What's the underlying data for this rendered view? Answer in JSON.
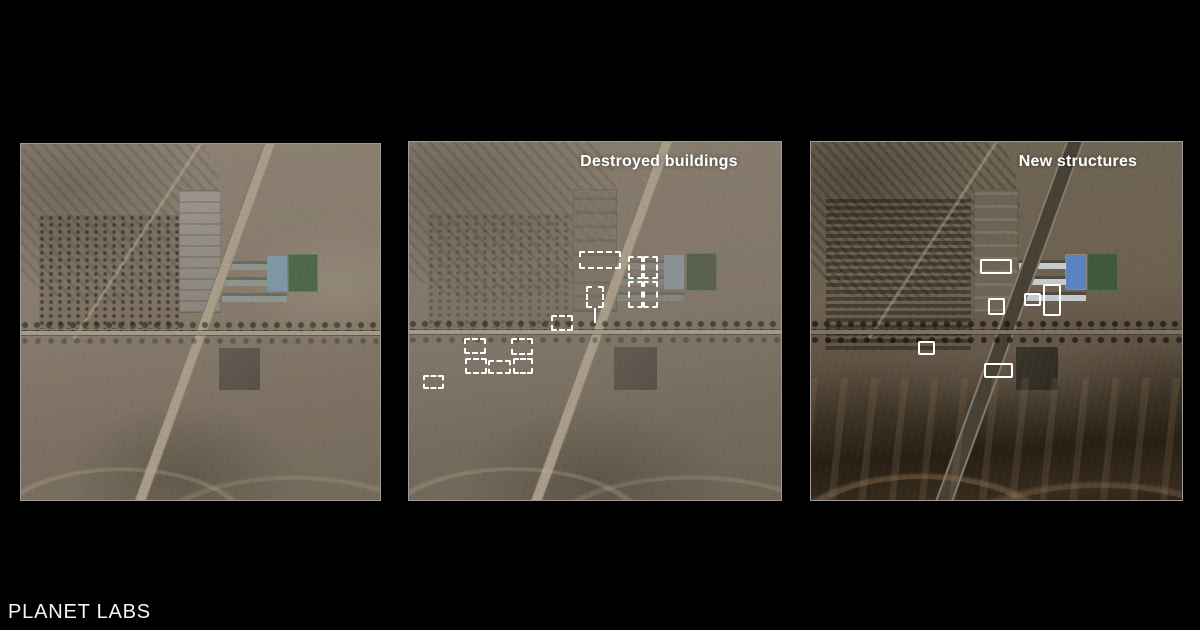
{
  "credit": {
    "text": "PLANET LABS"
  },
  "panels": {
    "before": {
      "label": ""
    },
    "destroyed": {
      "label": "Destroyed buildings",
      "marker_style": "dashed",
      "markers": [
        {
          "x": 170,
          "y": 109,
          "w": 42,
          "h": 18
        },
        {
          "x": 177,
          "y": 144,
          "w": 18,
          "h": 22
        },
        {
          "x": 219,
          "y": 114,
          "w": 15,
          "h": 23
        },
        {
          "x": 234,
          "y": 114,
          "w": 15,
          "h": 23
        },
        {
          "x": 219,
          "y": 139,
          "w": 15,
          "h": 27
        },
        {
          "x": 234,
          "y": 139,
          "w": 15,
          "h": 27
        },
        {
          "x": 142,
          "y": 173,
          "w": 22,
          "h": 16
        },
        {
          "x": 55,
          "y": 196,
          "w": 22,
          "h": 16
        },
        {
          "x": 102,
          "y": 196,
          "w": 22,
          "h": 17
        },
        {
          "x": 56,
          "y": 216,
          "w": 22,
          "h": 16
        },
        {
          "x": 79,
          "y": 218,
          "w": 23,
          "h": 14
        },
        {
          "x": 104,
          "y": 216,
          "w": 20,
          "h": 16
        },
        {
          "x": 14,
          "y": 233,
          "w": 21,
          "h": 14
        }
      ],
      "leader_lines": [
        {
          "x": 185,
          "y": 166,
          "h": 15
        }
      ]
    },
    "new": {
      "label": "New structures",
      "marker_style": "solid",
      "markers": [
        {
          "x": 169,
          "y": 117,
          "w": 32,
          "h": 15
        },
        {
          "x": 177,
          "y": 156,
          "w": 17,
          "h": 17
        },
        {
          "x": 213,
          "y": 151,
          "w": 17,
          "h": 13
        },
        {
          "x": 232,
          "y": 142,
          "w": 18,
          "h": 32
        },
        {
          "x": 107,
          "y": 199,
          "w": 17,
          "h": 14
        },
        {
          "x": 173,
          "y": 221,
          "w": 29,
          "h": 15
        }
      ],
      "leader_lines": []
    }
  },
  "colors": {
    "background": "#000000",
    "marker": "#ffffff",
    "label": "#ffffff"
  }
}
